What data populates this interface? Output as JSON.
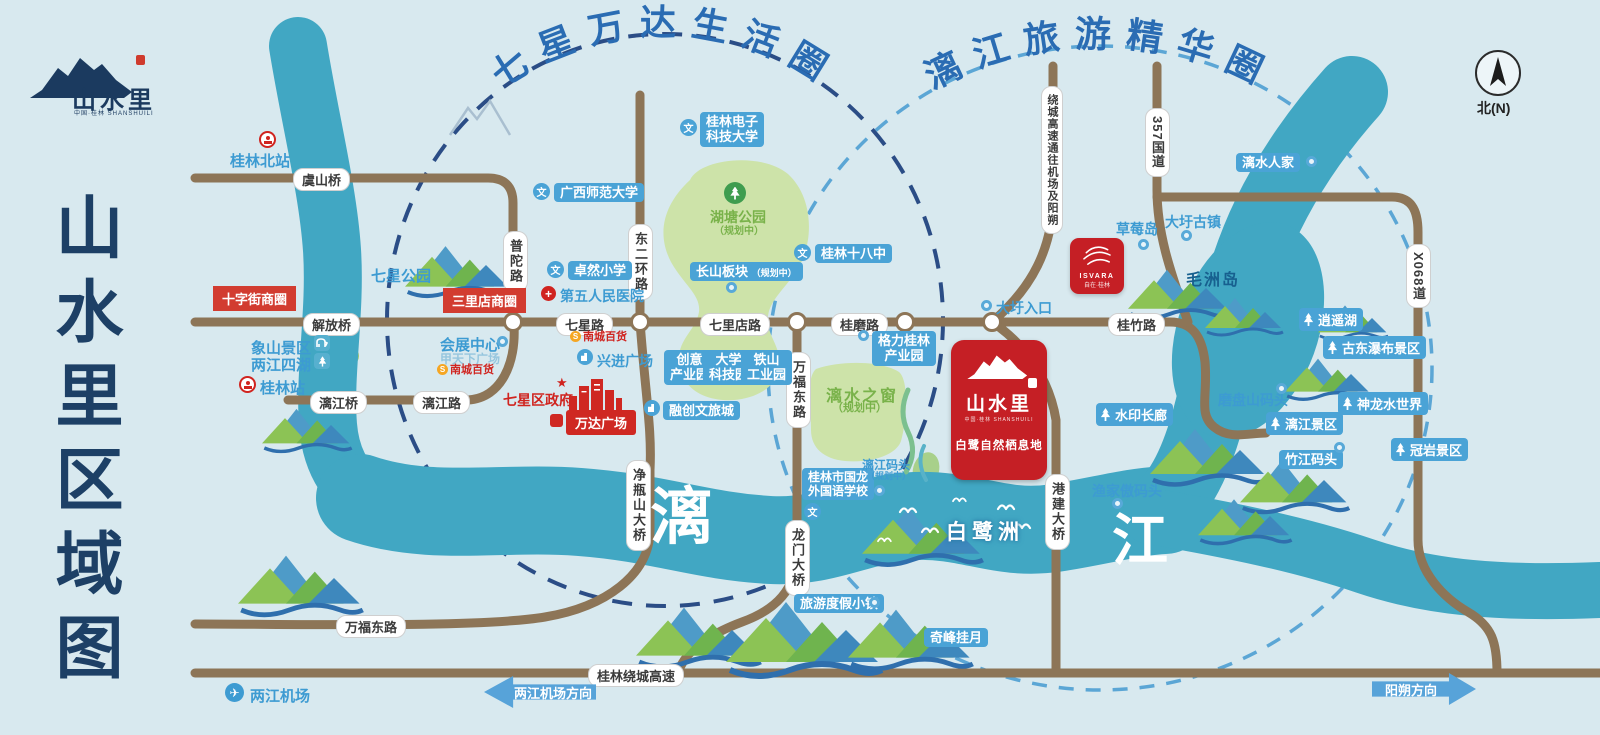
{
  "side_title": "山水里区域图",
  "logo": {
    "name": "山水里",
    "sub_cn": "中国·桂林",
    "sub_en": "SHANSHUILI"
  },
  "compass": {
    "label": "北(N)"
  },
  "arcs": {
    "left": "七星万达生活圈",
    "right": "漓江旅游精华圈"
  },
  "river_chars": {
    "li": "漓",
    "jiang": "江"
  },
  "roads": {
    "yushan": "虞山桥",
    "jiefang": "解放桥",
    "lijiangqiao": "漓江桥",
    "lijianglu": "漓江路",
    "qixing": "七星路",
    "qilidian": "七里店路",
    "guimo": "桂磨路",
    "guizhu": "桂竹路",
    "putuo": "普陀路",
    "dongerhuan": "东二环路",
    "wanfu": "万福东路",
    "jingping": "净瓶山大桥",
    "longmen": "龙门大桥",
    "gangjian": "港建大桥",
    "raocheng": "桂林绕城高速",
    "g357": "357国道",
    "raocheng_v": "绕城高速通往机场及阳朔",
    "x068": "X068道"
  },
  "stations": {
    "north": "桂林北站",
    "main": "桂林站",
    "airport": "两江机场"
  },
  "commercial": {
    "shizijie": "十字街商圈",
    "sanlidian": "三里店商圈",
    "wanda": "万达广场",
    "xingjin": "兴进广场",
    "huizhan": "会展中心",
    "jiatianxia": "甲天下广场",
    "nancheng": "南城百货",
    "qixing_gov": "七星区政府",
    "rongchuang": "融创文旅城"
  },
  "schools": {
    "guet_l1": "桂林电子",
    "guet_l2": "科技大学",
    "gxnu": "广西师范大学",
    "zhuoran": "卓然小学",
    "hospital": "第五人民医院",
    "no18": "桂林十八中",
    "guolong_l1": "桂林市国龙",
    "guolong_l2": "外国语学校"
  },
  "industry": {
    "cy_l1": "创意",
    "cy_l2": "产业园",
    "dx_l1": "大学",
    "dx_l2": "科技园",
    "ts_l1": "铁山",
    "ts_l2": "工业园",
    "geli_l1": "格力桂林",
    "geli_l2": "产业园"
  },
  "parks": {
    "qixing_park": "七星公园",
    "hutang": "湖塘公园",
    "planning": "（规划中）",
    "changshan": "长山板块",
    "lishuizhichuang": "漓水之窗",
    "xiangshan_l1": "象山景区",
    "xiangshan_l2": "两江四湖"
  },
  "project": {
    "name": "山水里",
    "sub_cn": "中国·桂林",
    "sub_en": "SHANSHUILI",
    "tagline": "白鹭自然栖息地"
  },
  "isvara": {
    "brand": "ISVARA",
    "sub": "自在·桂林"
  },
  "scenic": {
    "daxu_entry": "大圩入口",
    "strawberry": "草莓岛",
    "daxu_town": "大圩古镇",
    "maozhou": "毛洲岛",
    "lishuirenjia": "漓水人家",
    "xiaoyaohu": "逍遥湖",
    "gudong": "古东瀑布景区",
    "shenlong": "神龙水世界",
    "guanyan": "冠岩景区",
    "lijiang_scenic": "漓江景区",
    "shuiyin": "水印长廊",
    "egret": "白鹭洲",
    "resort": "旅游度假小镇",
    "qifeng": "奇峰挂月"
  },
  "docks": {
    "mopanshan": "磨盘山码头",
    "zhujiang": "竹江码头",
    "yujiaao": "渔家傲码头",
    "lijiang_dock": "漓江码头"
  },
  "arrows": {
    "airport_dir": "两江机场方向",
    "yangshuo_dir": "阳朔方向"
  },
  "colors": {
    "background": "#d8e9ef",
    "river": "#41a7c3",
    "road": "#8d7557",
    "label_blue": "#4aa3d6",
    "text_blue": "#3d9bd2",
    "red": "#d0241f",
    "park_green": "#cde3a9",
    "navy": "#1d4066"
  }
}
